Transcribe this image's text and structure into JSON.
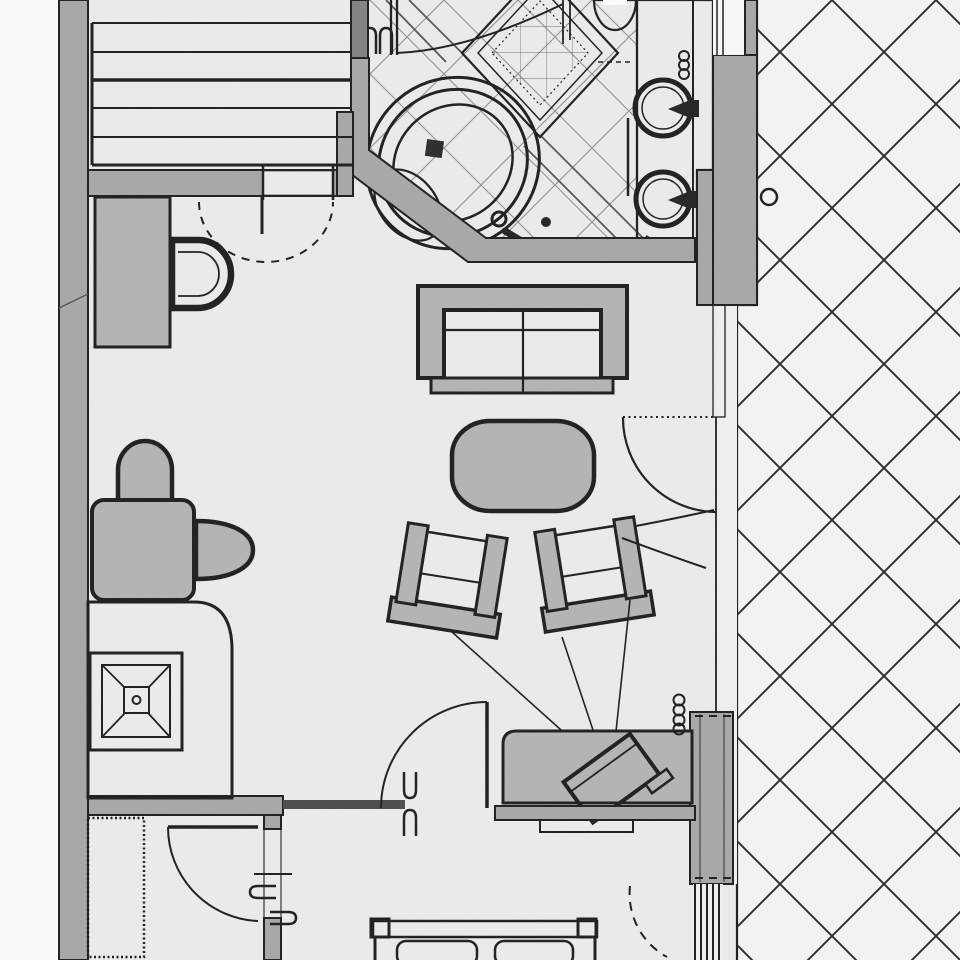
{
  "meta": {
    "type": "architectural-floor-plan",
    "subject": "Scanned floor plan of a hotel suite with bathroom, living room, bedroom and terrace",
    "view": "top-down plan view",
    "visible_text": []
  },
  "colors": {
    "paper": "#ffffff",
    "floor": "#eeedeb",
    "wall": "#a9a8a6",
    "walldark": "#83827f",
    "ink": "#1c1c1c",
    "furn": "#b5b4b2",
    "furn2": "#c6c5c3",
    "counter": "#f2f1ef",
    "terrace": "#f7f6f4",
    "tile": "#908f8d",
    "hatch": "#2b2b29",
    "basin": "#c9c8c6",
    "glass": "#e8e7e5"
  },
  "rooms": [
    {
      "name": "bathroom",
      "features": [
        "corner-bathtub",
        "diamond-mosaic-shower-inlay",
        "double-round-basin-vanity",
        "diagonal-floor-tiles"
      ]
    },
    {
      "name": "wc-dressing-area",
      "features": [
        "toilet",
        "side-cabinet",
        "dashed-door-swing"
      ]
    },
    {
      "name": "wardrobe-closet",
      "features": [
        "shelf-lines"
      ]
    },
    {
      "name": "living-room",
      "features": [
        "two-seat-sofa",
        "oval-coffee-table",
        "two-angled-armchairs",
        "tv-sideboard",
        "tv-viewing-lines",
        "desk-nook-with-two-chairs",
        "inlay-side-table"
      ]
    },
    {
      "name": "bedroom",
      "features": [
        "double-bed-headboard",
        "two-pillows",
        "wardrobe"
      ]
    },
    {
      "name": "terrace",
      "features": [
        "diagonal-crosshatch-paving",
        "round-drain"
      ]
    }
  ],
  "fixture_count": {
    "doors": 6,
    "basins": 2,
    "chairs": 4,
    "tables": 3
  }
}
